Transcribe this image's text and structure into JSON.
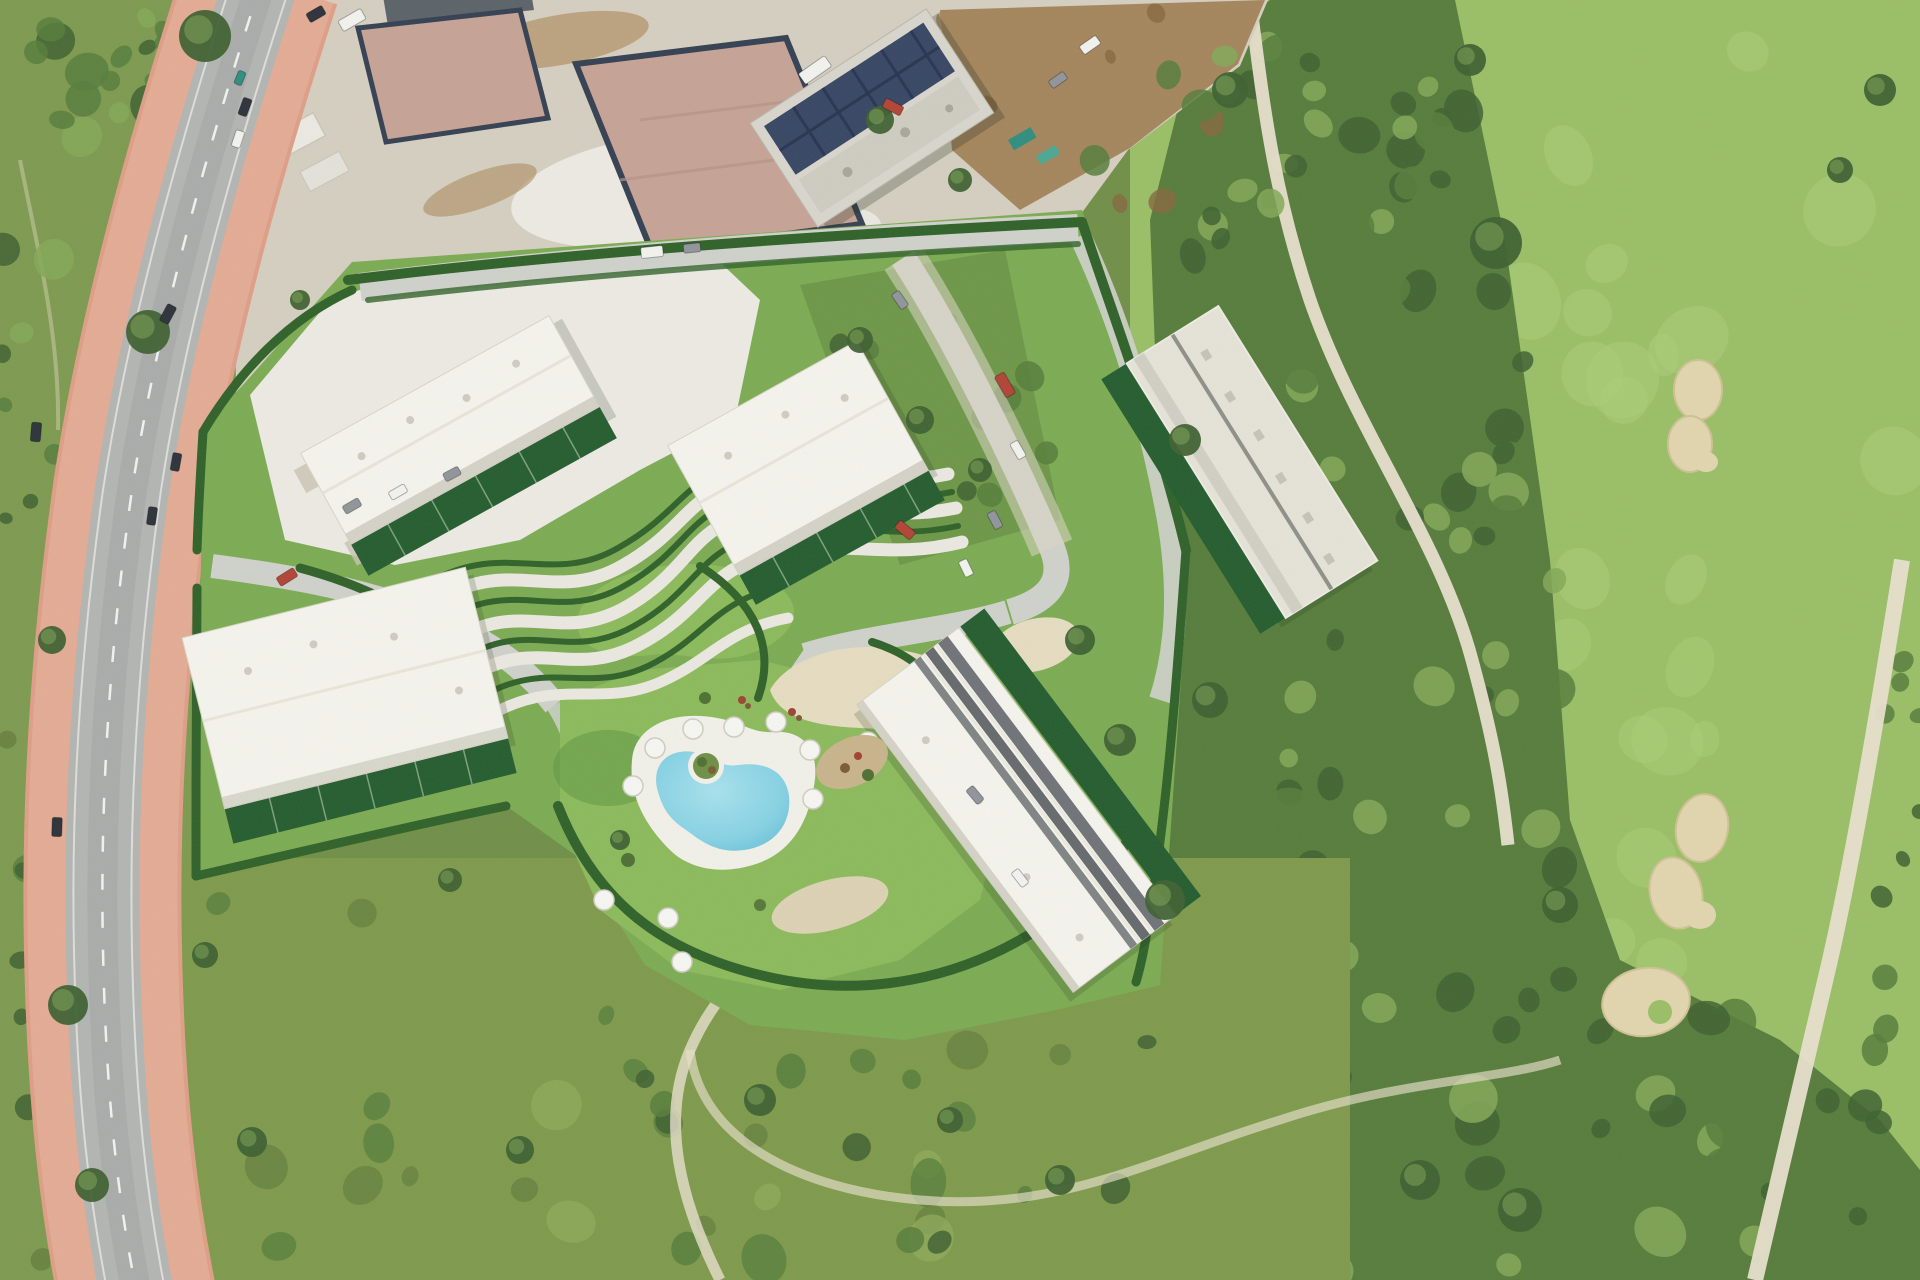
{
  "meta": {
    "type": "aerial-photograph",
    "description": "Aerial view of a residential development render with five white apartment buildings, landscaped S-curve gardens, a kidney-shaped pool with sun umbrellas, parking areas and hedged boundaries, set between a curving road with pink sidewalks, a construction site with foundation slabs and a solar-roof building, wild scrub, and a golf course with fairways, sand bunkers and cart paths."
  },
  "palette": {
    "base_scrub": "#708f47",
    "left_veg": "#7d9a4f",
    "tree_dark": "#3e6030",
    "tree_mid": "#567c3b",
    "tree_light": "#82a857",
    "fairway": "#9abf66",
    "fairway_light": "#abce77",
    "meadow": "#7e9a4b",
    "meadow_dark": "#647f3d",
    "meadow_light": "#8fa95a",
    "asphalt": "#b2b5b3",
    "asphalt_dark": "#9fa3a1",
    "pink": "#df9e87",
    "pink_light": "#ecbaa4",
    "curb": "#eae9e4",
    "gravel": "#d5cfc1",
    "gravel_bright": "#edebe4",
    "dirt": "#a4855c",
    "dirt_dark": "#86663f",
    "slab": "#c6a396",
    "slab_wall": "#333f52",
    "solar": "#364563",
    "solar_dark": "#273350",
    "concrete": "#d9d6cd",
    "site_lawn": "#7cab52",
    "lawn_bright": "#8cba5b",
    "lawn_dark": "#5f9542",
    "hedge": "#2f6128",
    "garden": "#235c2e",
    "site_road": "#d0d1cc",
    "site_path": "#ebe9e1",
    "plaza_sand": "#e6ddc1",
    "roof_white": "#f6f4ee",
    "roof_gray": "#e6e3d8",
    "roof_shadow": "#c7c4b8",
    "roof_band": "#60646a",
    "pool": "#86d2e5",
    "pool_hi": "#a8e2ee",
    "pool_deep": "#6cc2d8",
    "deck": "#f2f1ea",
    "sand": "#e2d6ae",
    "sand_dark": "#cfc194",
    "path_tan": "#e9e0cd",
    "car_red": "#b24335",
    "car_white": "#f3f3f0",
    "car_gray": "#90959a",
    "car_dark": "#2c313a",
    "car_teal": "#2f8d7f"
  },
  "scene": {
    "development_site": {
      "buildings": 5,
      "pool_count": 1,
      "umbrella_count": 11,
      "parking_areas": 3,
      "garden_plots": "dark green strips along each building"
    },
    "construction_zone": {
      "foundation_slabs": 2,
      "solar_roof_building": 1,
      "trailers": 2
    },
    "golf_course": {
      "bunkers": 3,
      "cart_paths": 2,
      "fairways": 2
    },
    "main_road": {
      "sidewalks": "pink both sides",
      "lane_marking": "dashed white"
    }
  },
  "vehicles": [
    {
      "x": 240,
      "y": 78,
      "a": -68,
      "c": "car_teal",
      "l": 14,
      "w": 8
    },
    {
      "x": 245,
      "y": 107,
      "a": -70,
      "c": "car_dark",
      "l": 18,
      "w": 9
    },
    {
      "x": 238,
      "y": 139,
      "a": -72,
      "c": "car_white",
      "l": 17,
      "w": 9
    },
    {
      "x": 168,
      "y": 314,
      "a": -62,
      "c": "car_dark",
      "l": 19,
      "w": 10
    },
    {
      "x": 36,
      "y": 432,
      "a": -85,
      "c": "car_dark",
      "l": 19,
      "w": 10
    },
    {
      "x": 176,
      "y": 462,
      "a": -80,
      "c": "car_dark",
      "l": 18,
      "w": 9
    },
    {
      "x": 152,
      "y": 516,
      "a": -82,
      "c": "car_dark",
      "l": 18,
      "w": 9
    },
    {
      "x": 57,
      "y": 827,
      "a": -88,
      "c": "car_dark",
      "l": 19,
      "w": 10
    },
    {
      "x": 352,
      "y": 20,
      "a": -30,
      "c": "car_white",
      "l": 26,
      "w": 12
    },
    {
      "x": 316,
      "y": 14,
      "a": -30,
      "c": "car_dark",
      "l": 18,
      "w": 10
    },
    {
      "x": 893,
      "y": 107,
      "a": 28,
      "c": "car_red",
      "l": 20,
      "w": 10
    },
    {
      "x": 815,
      "y": 70,
      "a": -35,
      "c": "car_white",
      "l": 32,
      "w": 13
    },
    {
      "x": 1090,
      "y": 45,
      "a": -35,
      "c": "car_white",
      "l": 20,
      "w": 10
    },
    {
      "x": 1058,
      "y": 80,
      "a": -35,
      "c": "car_gray",
      "l": 18,
      "w": 9
    },
    {
      "x": 652,
      "y": 252,
      "a": -6,
      "c": "car_white",
      "l": 22,
      "w": 11
    },
    {
      "x": 692,
      "y": 248,
      "a": -6,
      "c": "car_gray",
      "l": 17,
      "w": 9
    },
    {
      "x": 1005,
      "y": 385,
      "a": 60,
      "c": "car_red",
      "l": 24,
      "w": 11
    },
    {
      "x": 1018,
      "y": 450,
      "a": 60,
      "c": "car_white",
      "l": 18,
      "w": 9
    },
    {
      "x": 995,
      "y": 520,
      "a": 62,
      "c": "car_gray",
      "l": 18,
      "w": 9
    },
    {
      "x": 966,
      "y": 568,
      "a": 64,
      "c": "car_white",
      "l": 17,
      "w": 9
    },
    {
      "x": 900,
      "y": 300,
      "a": 55,
      "c": "car_gray",
      "l": 18,
      "w": 9
    },
    {
      "x": 905,
      "y": 530,
      "a": 40,
      "c": "car_red",
      "l": 20,
      "w": 10
    },
    {
      "x": 975,
      "y": 795,
      "a": 50,
      "c": "car_gray",
      "l": 18,
      "w": 9
    },
    {
      "x": 1020,
      "y": 878,
      "a": 52,
      "c": "car_white",
      "l": 18,
      "w": 9
    },
    {
      "x": 287,
      "y": 577,
      "a": -32,
      "c": "car_red",
      "l": 20,
      "w": 10
    },
    {
      "x": 352,
      "y": 506,
      "a": -30,
      "c": "car_gray",
      "l": 18,
      "w": 9
    },
    {
      "x": 398,
      "y": 492,
      "a": -30,
      "c": "car_white",
      "l": 18,
      "w": 9
    },
    {
      "x": 452,
      "y": 474,
      "a": -28,
      "c": "car_gray",
      "l": 17,
      "w": 9
    }
  ],
  "umbrellas": [
    [
      655,
      748
    ],
    [
      693,
      729
    ],
    [
      734,
      727
    ],
    [
      776,
      722
    ],
    [
      810,
      750
    ],
    [
      813,
      799
    ],
    [
      633,
      786
    ],
    [
      668,
      918
    ],
    [
      682,
      962
    ],
    [
      604,
      900
    ],
    [
      868,
      742
    ]
  ],
  "trees": [
    [
      205,
      36,
      26
    ],
    [
      148,
      332,
      22
    ],
    [
      52,
      640,
      14
    ],
    [
      68,
      1005,
      20
    ],
    [
      92,
      1185,
      17
    ],
    [
      252,
      1142,
      15
    ],
    [
      205,
      955,
      13
    ],
    [
      1496,
      243,
      26
    ],
    [
      1560,
      905,
      18
    ],
    [
      1470,
      60,
      16
    ],
    [
      1520,
      1210,
      22
    ],
    [
      1420,
      1180,
      20
    ],
    [
      880,
      120,
      14
    ],
    [
      960,
      180,
      12
    ],
    [
      1230,
      90,
      18
    ],
    [
      1185,
      440,
      16
    ],
    [
      1210,
      700,
      18
    ],
    [
      1165,
      900,
      20
    ],
    [
      860,
      340,
      13
    ],
    [
      920,
      420,
      14
    ],
    [
      980,
      470,
      12
    ],
    [
      1080,
      640,
      15
    ],
    [
      1120,
      740,
      16
    ],
    [
      450,
      880,
      12
    ],
    [
      620,
      840,
      10
    ],
    [
      300,
      300,
      10
    ],
    [
      760,
      1100,
      16
    ],
    [
      520,
      1150,
      14
    ],
    [
      950,
      1120,
      13
    ],
    [
      1060,
      1180,
      15
    ],
    [
      1880,
      90,
      16
    ],
    [
      1840,
      170,
      13
    ]
  ],
  "texture_regions": [
    {
      "target": "texture-left",
      "x": 0,
      "y": 0,
      "w": 150,
      "h": 400,
      "count": 22,
      "rmin": 8,
      "rmax": 20,
      "colors": [
        "tree_dark",
        "tree_mid",
        "tree_light"
      ],
      "seed": 1
    },
    {
      "target": "texture-left",
      "x": 0,
      "y": 380,
      "w": 80,
      "h": 880,
      "count": 20,
      "rmin": 6,
      "rmax": 14,
      "colors": [
        "tree_mid",
        "tree_dark",
        "meadow_dark"
      ],
      "seed": 2
    },
    {
      "target": "texture-left",
      "x": 150,
      "y": 0,
      "w": 80,
      "h": 180,
      "count": 8,
      "rmin": 6,
      "rmax": 12,
      "colors": [
        "tree_dark",
        "tree_mid"
      ],
      "seed": 3
    },
    {
      "target": "texture-golf-scrub",
      "x": 1180,
      "y": 0,
      "w": 300,
      "h": 260,
      "count": 26,
      "rmin": 9,
      "rmax": 22,
      "colors": [
        "tree_dark",
        "tree_mid",
        "tree_light"
      ],
      "seed": 4
    },
    {
      "target": "texture-golf-scrub",
      "x": 1220,
      "y": 260,
      "w": 320,
      "h": 320,
      "count": 30,
      "rmin": 9,
      "rmax": 22,
      "colors": [
        "tree_dark",
        "tree_mid",
        "tree_light"
      ],
      "seed": 5
    },
    {
      "target": "texture-golf-scrub",
      "x": 1260,
      "y": 580,
      "w": 310,
      "h": 360,
      "count": 30,
      "rmin": 9,
      "rmax": 22,
      "colors": [
        "tree_mid",
        "tree_dark",
        "tree_light"
      ],
      "seed": 6
    },
    {
      "target": "texture-golf-scrub",
      "x": 1300,
      "y": 940,
      "w": 470,
      "h": 340,
      "count": 34,
      "rmin": 10,
      "rmax": 24,
      "colors": [
        "tree_dark",
        "tree_mid",
        "tree_light"
      ],
      "seed": 7
    },
    {
      "target": "texture-golf-scrub",
      "x": 1760,
      "y": 1020,
      "w": 160,
      "h": 260,
      "count": 12,
      "rmin": 8,
      "rmax": 18,
      "colors": [
        "tree_dark",
        "tree_mid"
      ],
      "seed": 8
    },
    {
      "target": "texture-golf-scrub",
      "x": 1870,
      "y": 600,
      "w": 50,
      "h": 420,
      "count": 8,
      "rmin": 7,
      "rmax": 14,
      "colors": [
        "tree_dark",
        "tree_mid"
      ],
      "seed": 9
    },
    {
      "target": "texture-fairway",
      "x": 1500,
      "y": 20,
      "w": 400,
      "h": 560,
      "count": 14,
      "rmin": 18,
      "rmax": 42,
      "colors": [
        "fairway_light"
      ],
      "opacity": 0.5,
      "seed": 10
    },
    {
      "target": "texture-fairway",
      "x": 1560,
      "y": 620,
      "w": 160,
      "h": 400,
      "count": 8,
      "rmin": 16,
      "rmax": 36,
      "colors": [
        "fairway_light"
      ],
      "opacity": 0.45,
      "seed": 11
    },
    {
      "target": "texture-meadow",
      "x": 210,
      "y": 870,
      "w": 880,
      "h": 390,
      "count": 30,
      "rmin": 10,
      "rmax": 26,
      "colors": [
        "meadow_dark",
        "tree_mid",
        "meadow_light"
      ],
      "opacity": 0.75,
      "seed": 12
    },
    {
      "target": "texture-meadow",
      "x": 640,
      "y": 1020,
      "w": 520,
      "h": 250,
      "count": 12,
      "rmin": 8,
      "rmax": 18,
      "colors": [
        "tree_dark",
        "tree_mid"
      ],
      "seed": 13
    },
    {
      "target": "texture-ne",
      "x": 1090,
      "y": 40,
      "w": 370,
      "h": 220,
      "count": 16,
      "rmin": 8,
      "rmax": 18,
      "colors": [
        "tree_mid",
        "tree_dark",
        "tree_light"
      ],
      "seed": 14
    },
    {
      "target": "texture-construction",
      "x": 900,
      "y": 10,
      "w": 330,
      "h": 200,
      "count": 12,
      "rmin": 6,
      "rmax": 16,
      "colors": [
        "dirt_dark",
        "dirt"
      ],
      "opacity": 0.8,
      "seed": 15
    },
    {
      "target": "texture-site-veg",
      "x": 820,
      "y": 270,
      "w": 230,
      "h": 270,
      "count": 12,
      "rmin": 8,
      "rmax": 16,
      "colors": [
        "tree_mid",
        "tree_dark"
      ],
      "seed": 16
    }
  ]
}
